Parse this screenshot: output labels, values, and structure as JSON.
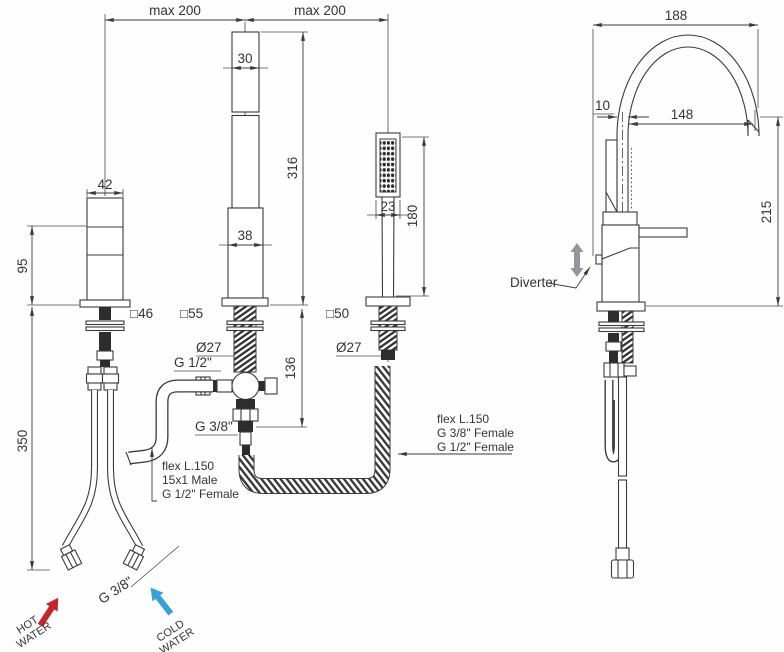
{
  "front_view": {
    "dims": {
      "max_left": "max 200",
      "max_right": "max 200",
      "spout_top_width": "30",
      "spout_height": "316",
      "handle_width": "42",
      "handle_height": "95",
      "handle_hole": "□46",
      "spout_hole": "□55",
      "shower_hole": "□50",
      "spout_body_width": "38",
      "shower_head_width": "23",
      "shower_length": "180",
      "spout_shank_dia": "Ø27",
      "shower_shank_dia": "Ø27",
      "spout_inlet_thread": "G 1/2\"",
      "spout_outlet_thread": "G 3/8\"",
      "underdeck_depth": "136",
      "hose_length": "350",
      "supply_thread": "G 3/8\""
    },
    "labels": {
      "left_hose": [
        "flex L.150",
        "15x1 Male",
        "G 1/2\" Female"
      ],
      "right_hose": [
        "flex L.150",
        "G 3/8\" Female",
        "G 1/2\" Female"
      ],
      "hot": [
        "HOT",
        "WATER"
      ],
      "cold": [
        "COLD",
        "WATER"
      ]
    }
  },
  "side_view": {
    "dims": {
      "spout_reach_overall": "188",
      "spout_tube_width": "10",
      "spout_reach_outlet": "148",
      "height_above_deck": "215"
    },
    "labels": {
      "diverter": "Diverter"
    }
  },
  "colors": {
    "line": "#3b3b3b",
    "hot_arrow": "#c5262c",
    "cold_arrow": "#3aa0d9",
    "diverter_arrow": "#939598"
  }
}
